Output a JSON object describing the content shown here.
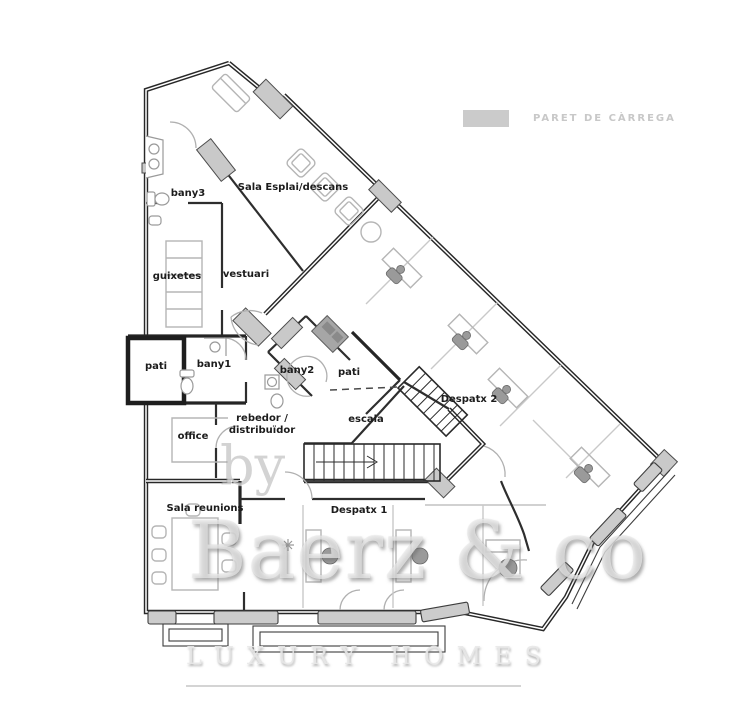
{
  "legend": {
    "label": "PARET DE CÀRREGA"
  },
  "rooms": {
    "bany3": "bany3",
    "sala_esplai": "Sala Esplai/descans",
    "guixetes": "guixetes",
    "vestuari": "vestuari",
    "pati_left": "pati",
    "bany1": "bany1",
    "bany2": "bany2",
    "pati_center": "pati",
    "rebedor_line1": "rebedor /",
    "rebedor_line2": "distribuïdor",
    "escala": "escala",
    "despatx2": "Despatx 2",
    "office": "office",
    "sala_reunions": "Sala reunions",
    "despatx1": "Despatx 1"
  },
  "watermark": {
    "by": "by",
    "brand": "Baerz & co",
    "tagline": "LUXURY HOMES"
  },
  "palette": {
    "wall": "#282828",
    "load_bearing_fill": "#c9c9c9",
    "window_fill": "#cccccc",
    "furniture_stroke": "#b5b5b5",
    "room_label": "#1c1c1c",
    "legend_text": "#c8c8c8",
    "watermark_gray": "#d4d4d4"
  }
}
